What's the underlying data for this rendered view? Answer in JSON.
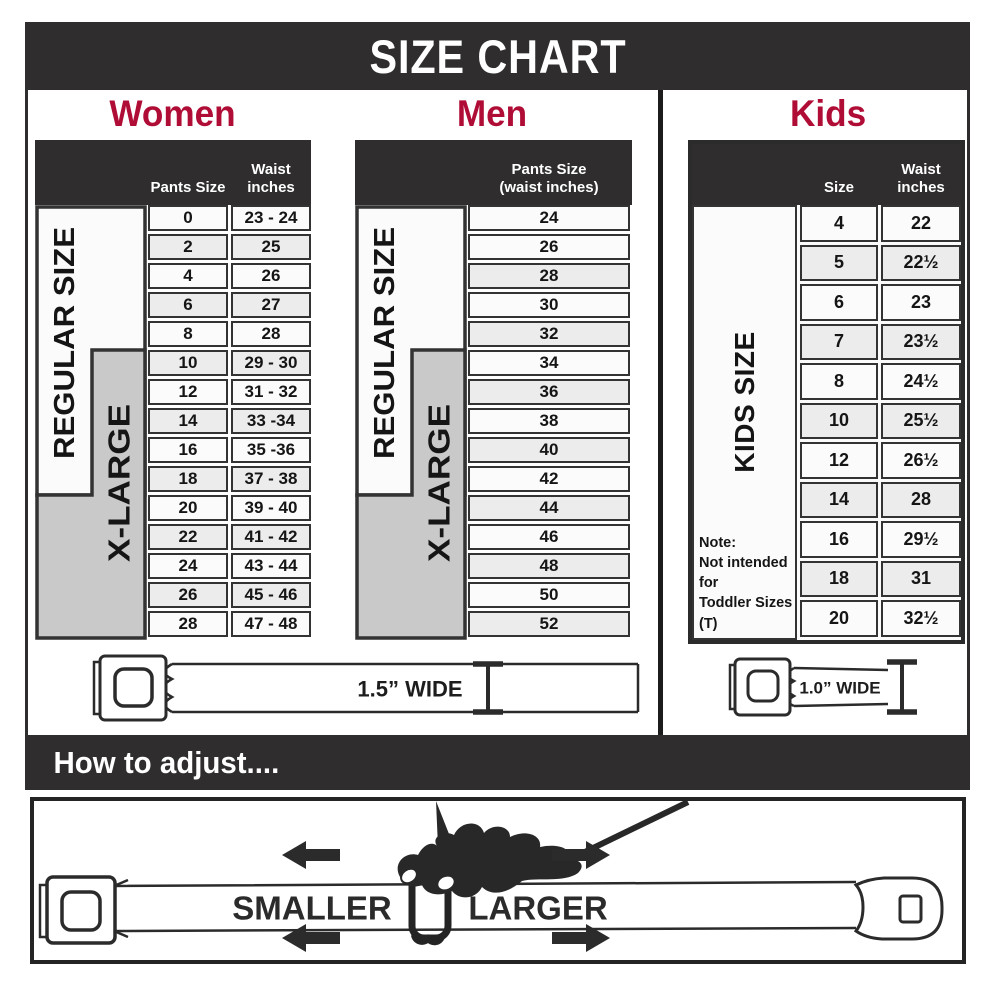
{
  "title": "SIZE CHART",
  "colors": {
    "header_bg": "#2F2D2E",
    "accent_red": "#B00D36",
    "cell_border": "#333333",
    "cell_bg": "#FBFBFB",
    "cell_shaded": "#ECECEC",
    "xlarge_gray": "#C9C9C9",
    "line_dark": "#2B2B2B"
  },
  "panels": {
    "women": {
      "title": "Women",
      "col_pants": "Pants Size",
      "col_waist_line1": "Waist",
      "col_waist_line2": "inches",
      "regular_label": "REGULAR SIZE",
      "xlarge_label": "X-LARGE",
      "rows": [
        {
          "size": "0",
          "waist": "23 - 24",
          "shaded": false
        },
        {
          "size": "2",
          "waist": "25",
          "shaded": true
        },
        {
          "size": "4",
          "waist": "26",
          "shaded": false
        },
        {
          "size": "6",
          "waist": "27",
          "shaded": true
        },
        {
          "size": "8",
          "waist": "28",
          "shaded": false
        },
        {
          "size": "10",
          "waist": "29 - 30",
          "shaded": true
        },
        {
          "size": "12",
          "waist": "31 - 32",
          "shaded": false
        },
        {
          "size": "14",
          "waist": "33 -34",
          "shaded": true
        },
        {
          "size": "16",
          "waist": "35 -36",
          "shaded": false
        },
        {
          "size": "18",
          "waist": "37 - 38",
          "shaded": true
        },
        {
          "size": "20",
          "waist": "39 - 40",
          "shaded": false
        },
        {
          "size": "22",
          "waist": "41 - 42",
          "shaded": true
        },
        {
          "size": "24",
          "waist": "43 - 44",
          "shaded": false
        },
        {
          "size": "26",
          "waist": "45 - 46",
          "shaded": true
        },
        {
          "size": "28",
          "waist": "47 - 48",
          "shaded": false
        }
      ]
    },
    "men": {
      "title": "Men",
      "header_line1": "Pants Size",
      "header_line2": "(waist inches)",
      "regular_label": "REGULAR SIZE",
      "xlarge_label": "X-LARGE",
      "rows": [
        {
          "size": "24",
          "shaded": false
        },
        {
          "size": "26",
          "shaded": false
        },
        {
          "size": "28",
          "shaded": true
        },
        {
          "size": "30",
          "shaded": false
        },
        {
          "size": "32",
          "shaded": true
        },
        {
          "size": "34",
          "shaded": false
        },
        {
          "size": "36",
          "shaded": true
        },
        {
          "size": "38",
          "shaded": false
        },
        {
          "size": "40",
          "shaded": true
        },
        {
          "size": "42",
          "shaded": false
        },
        {
          "size": "44",
          "shaded": true
        },
        {
          "size": "46",
          "shaded": false
        },
        {
          "size": "48",
          "shaded": true
        },
        {
          "size": "50",
          "shaded": false
        },
        {
          "size": "52",
          "shaded": true
        }
      ]
    },
    "kids": {
      "title": "Kids",
      "col_size": "Size",
      "col_waist_line1": "Waist",
      "col_waist_line2": "inches",
      "label": "KIDS SIZE",
      "note_line1": "Note:",
      "note_line2": "Not intended for",
      "note_line3": "Toddler Sizes (T)",
      "rows": [
        {
          "size": "4",
          "waist": "22",
          "shaded": false
        },
        {
          "size": "5",
          "waist": "22½",
          "shaded": true
        },
        {
          "size": "6",
          "waist": "23",
          "shaded": false
        },
        {
          "size": "7",
          "waist": "23½",
          "shaded": true
        },
        {
          "size": "8",
          "waist": "24½",
          "shaded": false
        },
        {
          "size": "10",
          "waist": "25½",
          "shaded": true
        },
        {
          "size": "12",
          "waist": "26½",
          "shaded": false
        },
        {
          "size": "14",
          "waist": "28",
          "shaded": true
        },
        {
          "size": "16",
          "waist": "29½",
          "shaded": false
        },
        {
          "size": "18",
          "waist": "31",
          "shaded": true
        },
        {
          "size": "20",
          "waist": "32½",
          "shaded": false
        }
      ]
    }
  },
  "belts": {
    "adult_width_label": "1.5” WIDE",
    "kids_width_label": "1.0” WIDE"
  },
  "adjust": {
    "heading": "How to adjust....",
    "smaller_label": "SMALLER",
    "larger_label": "LARGER"
  }
}
